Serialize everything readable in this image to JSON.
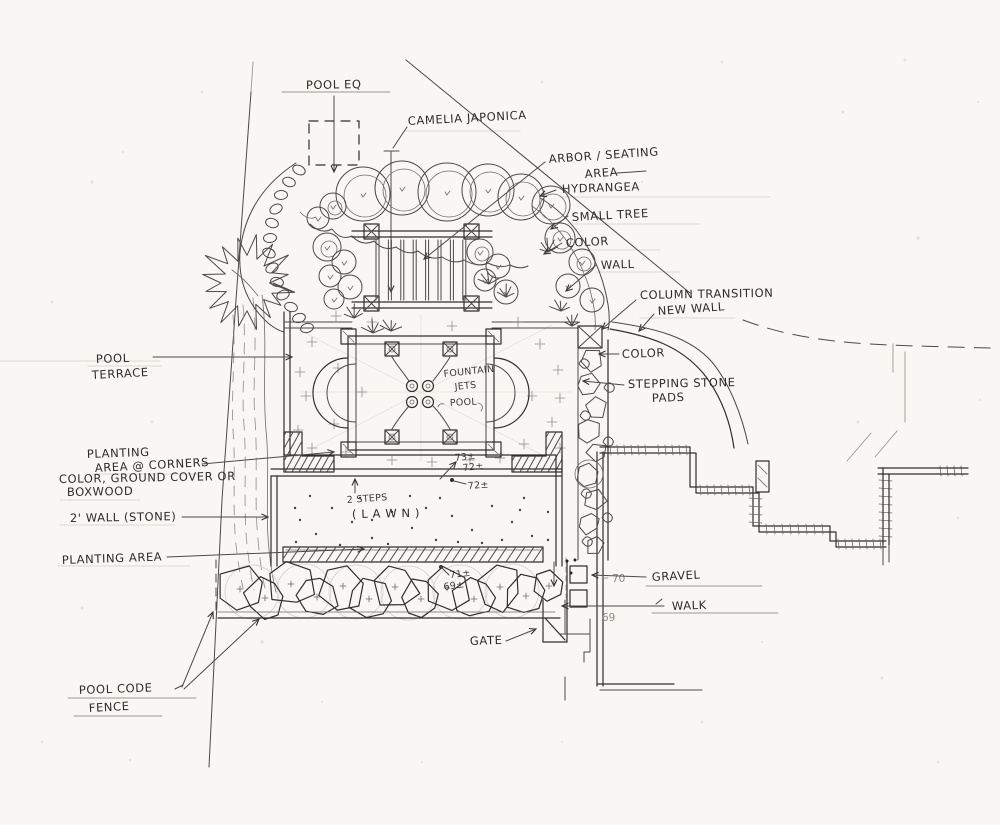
{
  "labels": {
    "pool_eq": "POOL EQ",
    "camelia": "CAMELIA JAPONICA",
    "arbor_line1": "ARBOR / SEATING",
    "arbor_line2": "AREA",
    "hydrangea": "HYDRANGEA",
    "small_tree": "SMALL TREE",
    "color_upper": "COLOR",
    "wall": "WALL",
    "column_transition": "COLUMN TRANSITION",
    "new_wall": "NEW WALL",
    "color_right": "COLOR",
    "stepping_line1": "STEPPING STONE",
    "stepping_line2": "PADS",
    "pool_terrace_line1": "POOL",
    "pool_terrace_line2": "TERRACE",
    "fountain_line1": "FOUNTAIN",
    "fountain_line2": "JETS",
    "pool": "POOL",
    "planting_corners_line1": "PLANTING",
    "planting_corners_line2": "AREA @ CORNERS",
    "ground_cover_line1": "COLOR, GROUND COVER OR",
    "ground_cover_line2": "BOXWOOD",
    "stone_wall": "2' WALL (STONE)",
    "two_steps": "2 STEPS",
    "lawn": "( L A W N )",
    "planting_area": "PLANTING AREA",
    "gravel": "GRAVEL",
    "walk": "WALK",
    "gate": "GATE",
    "pool_code_line1": "POOL CODE",
    "pool_code_line2": "FENCE"
  },
  "elevations": {
    "terrace_73": "73±",
    "steps_72": "72±",
    "lawn_72": "72±",
    "shrubs_71": "71±",
    "shrubs_69": "69±",
    "gravel_70": "70",
    "walk_69": "69"
  }
}
